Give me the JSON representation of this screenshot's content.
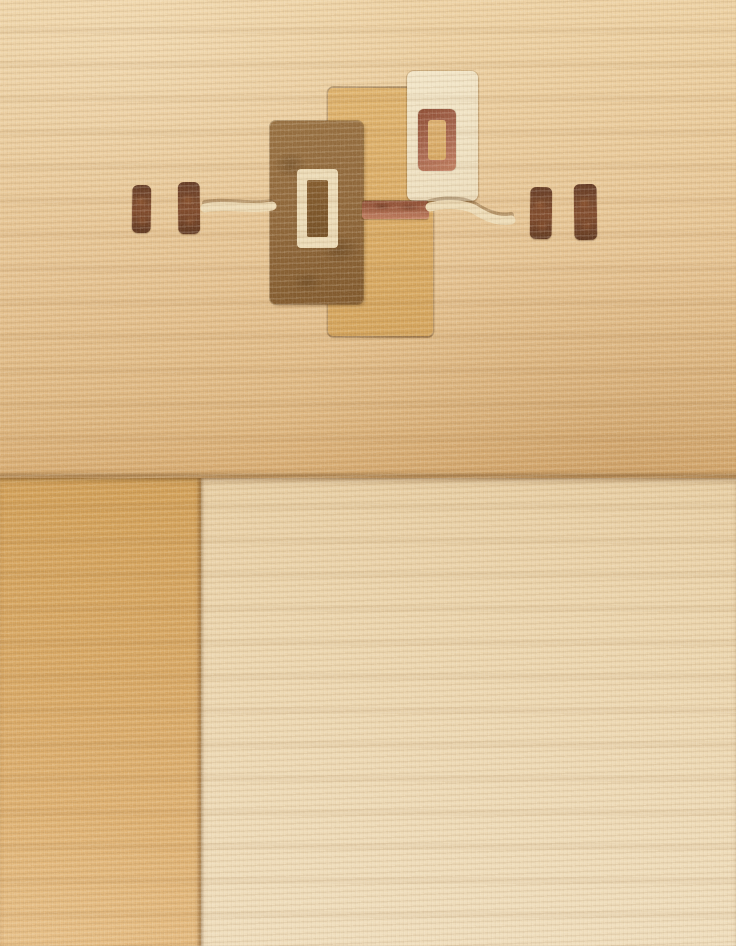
{
  "description": "Close-up photograph of a hand-knotted wool rug in warm beige and tan tones. The upper field shows a geometric motif of overlapping rectangles: a dark brown rectangle with a cream open-frame inside, a tan rectangle behind it, a cream rectangle with a rust open-frame at the upper right, a rust bar and thin cream lines running horizontally, flanked by two pairs of small dark-brown dashes. The lower part of the rug is divided into a golden-tan block on the left and a light cream block on the right.",
  "elements": {
    "upper_field": "tan woven field with geometric motif",
    "gold_block": "golden-tan colour block, lower left",
    "cream_block": "light cream colour block, lower right",
    "motif": [
      "brown-rectangle",
      "cream-inner-frame",
      "tan-rectangle",
      "cream-rectangle",
      "rust-inner-frame",
      "rust-bar",
      "cream-line-left",
      "cream-line-right",
      "dash-pair-left",
      "dash-pair-right"
    ]
  },
  "palette": {
    "field_top": "#eccf9f",
    "field_mid": "#e4c08d",
    "field_low": "#dcb37b",
    "field_deep": "#d5a76b",
    "gold_top": "#cf9b51",
    "gold_low": "#e2b577",
    "cream_top": "#e6cb9e",
    "cream_low": "#eedbb8",
    "tan_hi": "#ddaf67",
    "tan_lo": "#d2a056",
    "brown_hi": "#936b3c",
    "brown_lo": "#7a5226",
    "brown_core": "#7f5628",
    "creamrect": "#f1e4c5",
    "creamframe": "#ebd9b3",
    "rust_dk": "#8a4830",
    "rust_mid": "#a5624a",
    "rust_lt": "#c17b5d",
    "dash_dk": "#5e3520",
    "dash_lt": "#7b4527"
  }
}
